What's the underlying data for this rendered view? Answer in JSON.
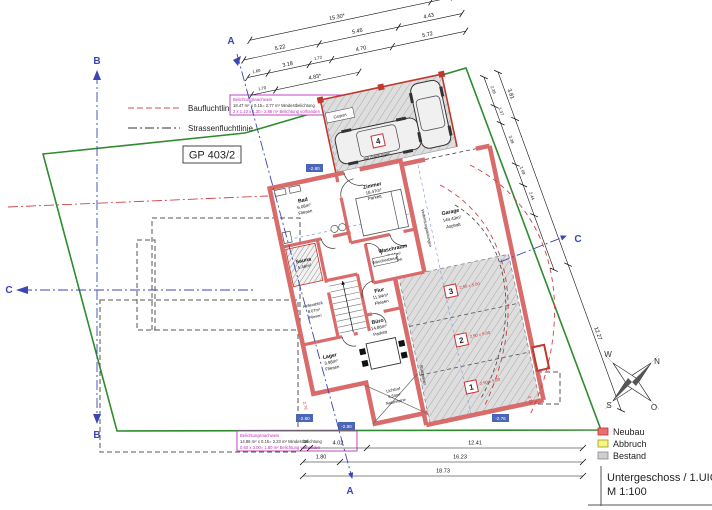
{
  "colors": {
    "boundary": "#2e8b2e",
    "neubau_wall": "#d96b6b",
    "neubau_dark": "#c0392b",
    "section_blue": "#3a46b4",
    "note_magenta": "#bb33bb",
    "bestand_gray": "#cfcfcf",
    "abbruch_yellow": "#f5f580"
  },
  "legend_lines": {
    "bau": "Baufluchtlinie",
    "strasse": "Strassenfluchtlinie"
  },
  "parcel": {
    "label": "GP 403/2"
  },
  "notes": {
    "top": {
      "l1": "Belichtungsnachweis",
      "l2": "18.47 m² x 0.15= 2.77 m² Mindestbelichtung",
      "l3": "2 x 1.10 x 1.30= 2.86 m² Belichtung vorhanden"
    },
    "bottom": {
      "l1": "Belichtungsnachweis",
      "l2": "14.86 m² x 0.15= 2.23 m² Mindestbelichtung",
      "l3": "0.60 x 3.00= 1.80 m² Belichtung vorhanden"
    }
  },
  "rooms": {
    "zimmer": {
      "name": "Zimmer",
      "area": "18.47m²",
      "floor": "Parkett"
    },
    "bad": {
      "name": "Bad",
      "area": "6.08m²",
      "floor": "Fliesen"
    },
    "sauna": {
      "name": "Sauna",
      "area": "5.46m²"
    },
    "kellerabteil": {
      "name": "Kellerabteil",
      "area": "8.07m²",
      "floor": "Fliesen"
    },
    "lager": {
      "name": "Lager",
      "area": "3.98m²",
      "floor": "Fliesen"
    },
    "flur": {
      "name": "Flur",
      "area": "11.84m²",
      "floor": "Fliesen"
    },
    "waschraum": {
      "name": "Waschraum",
      "area": "7.44m²",
      "floor": "Fliesen"
    },
    "buero": {
      "name": "Büro",
      "area": "14.86m²",
      "floor": "Parkett"
    },
    "lichthof": {
      "name": "Lichthof",
      "area": "6.54m²",
      "floor": "Natursteine"
    },
    "garage": {
      "name": "Garage",
      "area": "149.43m²",
      "floor": "Asphalt"
    },
    "carport": {
      "name": "Carport"
    }
  },
  "stalls": [
    {
      "no": "1",
      "dim": "2.50 x 5.00"
    },
    {
      "no": "2",
      "dim": "2.50 x 5.00"
    },
    {
      "no": "3",
      "dim": "2.50 x 5.00"
    },
    {
      "no": "4",
      "dim": "2.50 x 5.00"
    }
  ],
  "annotations": {
    "verbindung": "Verbindungsleitungen",
    "stuetzmauer": "Stützmauer",
    "waesche": "Wäscheabwurf",
    "zuleitung": "mit Zuleitungen"
  },
  "elevations": [
    "-2.80",
    "-2.80",
    "-2.76",
    "-2.80"
  ],
  "dims": {
    "top": {
      "r1": [
        "15.30*",
        "2.38"
      ],
      "r2": [
        "5.22",
        "5.46",
        "4.43"
      ],
      "r3": [
        "1.60",
        "3.18",
        "1.72",
        "4.70",
        "5.72"
      ],
      "r4": [
        "1.70",
        "4.83*"
      ]
    },
    "right": {
      "outer": [
        "3.81",
        "12.27"
      ],
      "inner": [
        "2.39",
        "1.37",
        "3.39",
        "1.69",
        "2.44"
      ]
    },
    "bottom": {
      "r1": [
        "36",
        "4.02",
        "12.41"
      ],
      "r2": [
        "1.80",
        "16.23"
      ],
      "r3": [
        "18.73"
      ]
    }
  },
  "sections": {
    "a": "A",
    "b": "B",
    "c": "C"
  },
  "compass": {
    "n": "N",
    "e": "O",
    "s": "S",
    "w": "W"
  },
  "legend_fill": [
    {
      "label": "Neubau",
      "color": "#e87070"
    },
    {
      "label": "Abbruch",
      "color": "#f5f580"
    },
    {
      "label": "Bestand",
      "color": "#cfcfcf"
    }
  ],
  "title_block": {
    "line1": "Untergeschoss / 1.UIG",
    "line2": "M 1:100"
  }
}
